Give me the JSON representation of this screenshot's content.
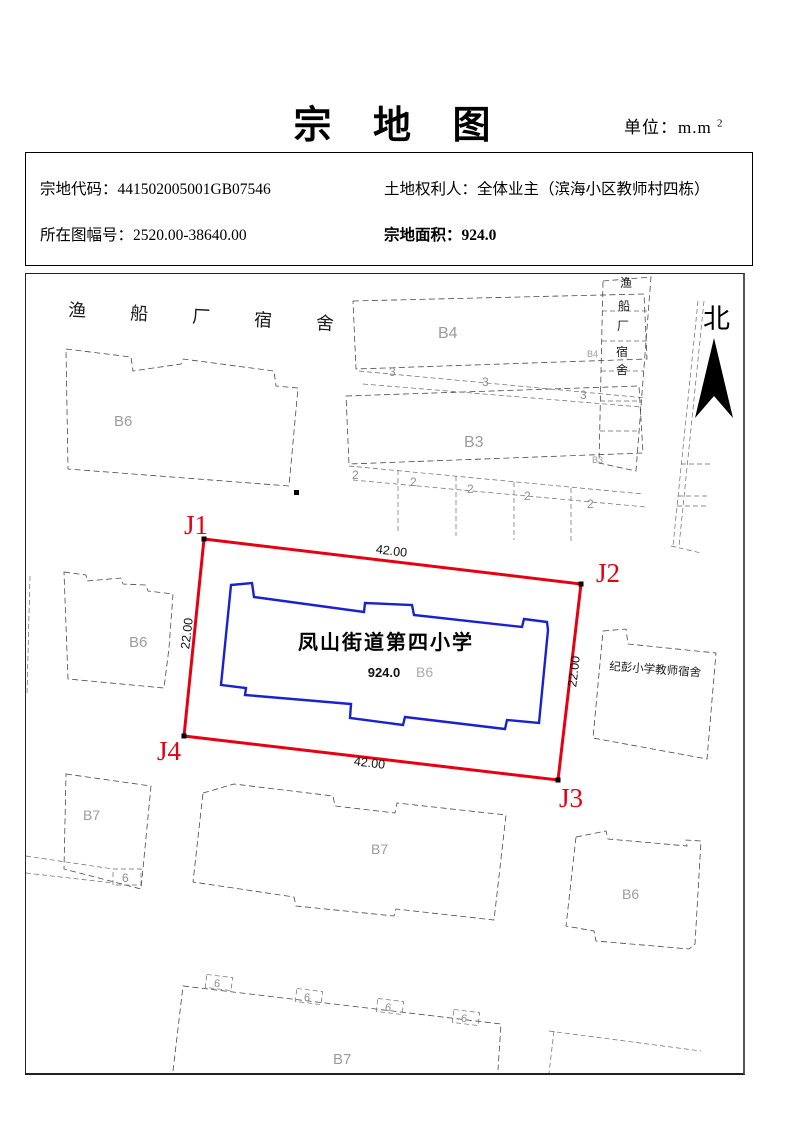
{
  "page": {
    "title": "宗 地 图",
    "unit_label": "单位：m.m",
    "unit_sup": "2"
  },
  "info": {
    "parcel_code_label": "宗地代码：",
    "parcel_code": "441502005001GB07546",
    "rights_holder_label": "土地权利人：",
    "rights_holder": "全体业主（滨海小区教师村四栋）",
    "sheet_label": "所在图幅号：",
    "sheet": "2520.00-38640.00",
    "area_label": "宗地面积：",
    "area": "924.0"
  },
  "map": {
    "north": "北",
    "top_dorm": "渔船厂宿舍",
    "side_dorm": [
      "渔",
      "船",
      "厂",
      "宿",
      "舍"
    ],
    "right_building": "纪彭小学教师宿舍",
    "parcel": {
      "color": "#e60012",
      "corners": [
        "J1",
        "J2",
        "J3",
        "J4"
      ],
      "len_top": "42.00",
      "len_bottom": "42.00",
      "len_left": "22.00",
      "len_right": "22.00"
    },
    "school": {
      "color": "#1822cf",
      "name": "凤山街道第四小学",
      "area": "924.0",
      "code": "B6"
    },
    "labels": {
      "b4": "B4",
      "b4s": "B4",
      "b3": "B3",
      "b3s": "B3",
      "b6nw": "B6",
      "b6w": "B6",
      "b6se": "B6",
      "b7w": "B7",
      "b7c": "B7",
      "b7s": "B7",
      "n3": "3",
      "n2": "2",
      "n6": "6"
    }
  }
}
